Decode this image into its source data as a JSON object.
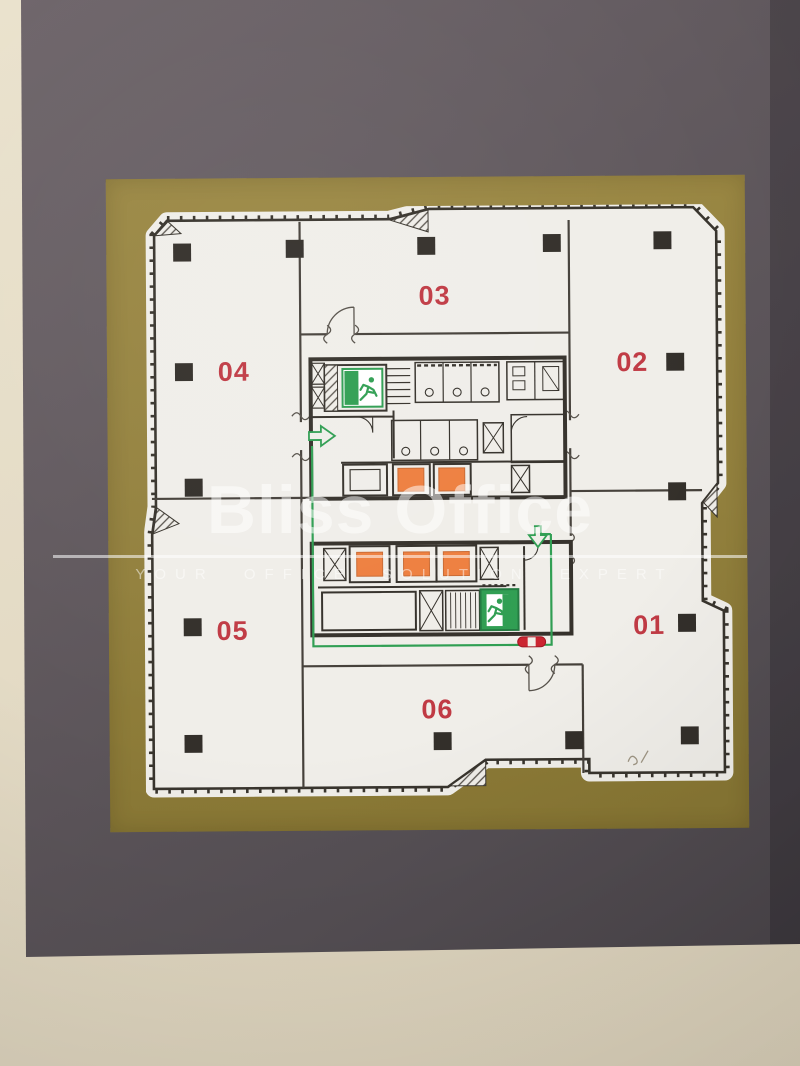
{
  "watermark": {
    "brand": "Bliss Office",
    "tagline": "YOUR OFFICE SOLUTION EXPERT"
  },
  "floor_plan": {
    "units": [
      {
        "label": "01"
      },
      {
        "label": "02"
      },
      {
        "label": "03"
      },
      {
        "label": "04"
      },
      {
        "label": "05"
      },
      {
        "label": "06"
      }
    ],
    "symbols": {
      "exit_sign": "green running-man fire exit",
      "elevator_marker": "orange lift car",
      "escape_route": "green evacuation route with arrows",
      "fire_point": "red oval marker",
      "column": "black structural column"
    },
    "colors": {
      "unit_number": "#c03a44",
      "elevator": "#ee7f3f",
      "route_green": "#2f9e52",
      "walls": "#38342d",
      "paper": "#f0eee9",
      "gold_mat": "#92803d",
      "plaque": "#5d555a",
      "wall_paint": "#e4dcc6"
    }
  }
}
